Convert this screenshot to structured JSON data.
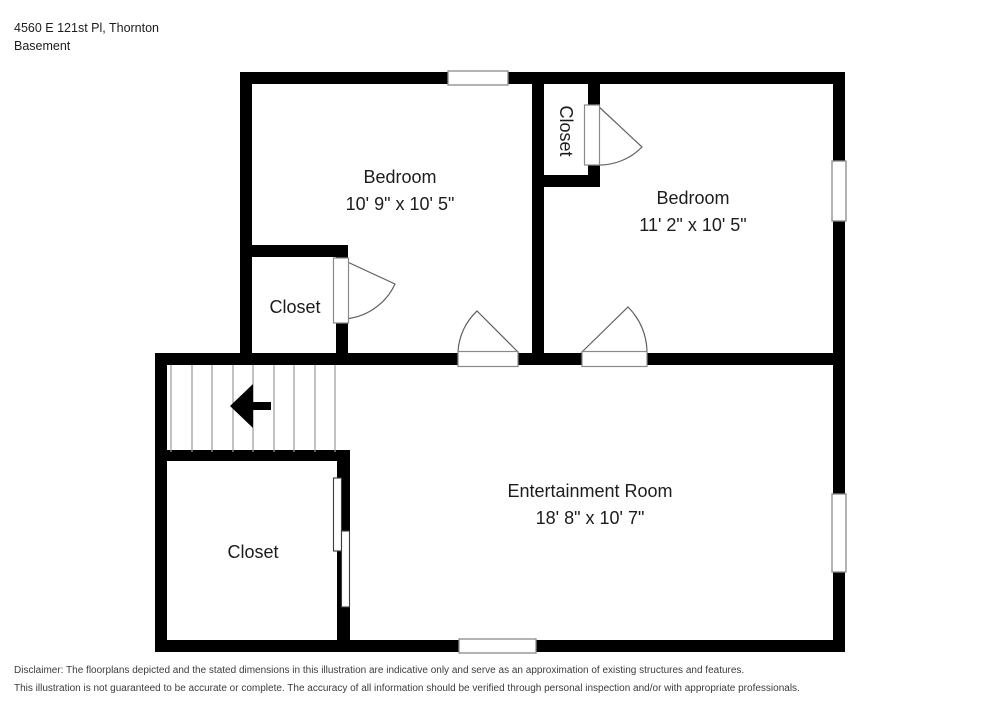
{
  "header": {
    "address": "4560 E 121st Pl, Thornton",
    "floor_label": "Basement"
  },
  "rooms": {
    "bedroom_left": {
      "name": "Bedroom",
      "dimensions": "10' 9\" x 10' 5\""
    },
    "bedroom_right": {
      "name": "Bedroom",
      "dimensions": "11' 2\" x 10' 5\""
    },
    "closet_top": {
      "name": "Closet"
    },
    "closet_mid": {
      "name": "Closet"
    },
    "closet_bottom": {
      "name": "Closet"
    },
    "entertainment": {
      "name": "Entertainment Room",
      "dimensions": "18' 8\" x 10' 7\""
    }
  },
  "stairs": {
    "direction": "left"
  },
  "disclaimer": {
    "line1": "Disclaimer: The floorplans depicted and the stated dimensions in this illustration are indicative only and serve as an approximation of existing structures and features.",
    "line2": "This illustration is not guaranteed to be accurate or complete. The accuracy of all information should be verified through personal inspection and/or with appropriate professionals."
  },
  "colors": {
    "wall": "#000000",
    "text": "#1c1c1c",
    "disclaimer_text": "#3c3c3c",
    "window_stroke": "#8a8a8a",
    "door_stroke": "#606060",
    "tread_stroke": "#9a9a9a"
  }
}
